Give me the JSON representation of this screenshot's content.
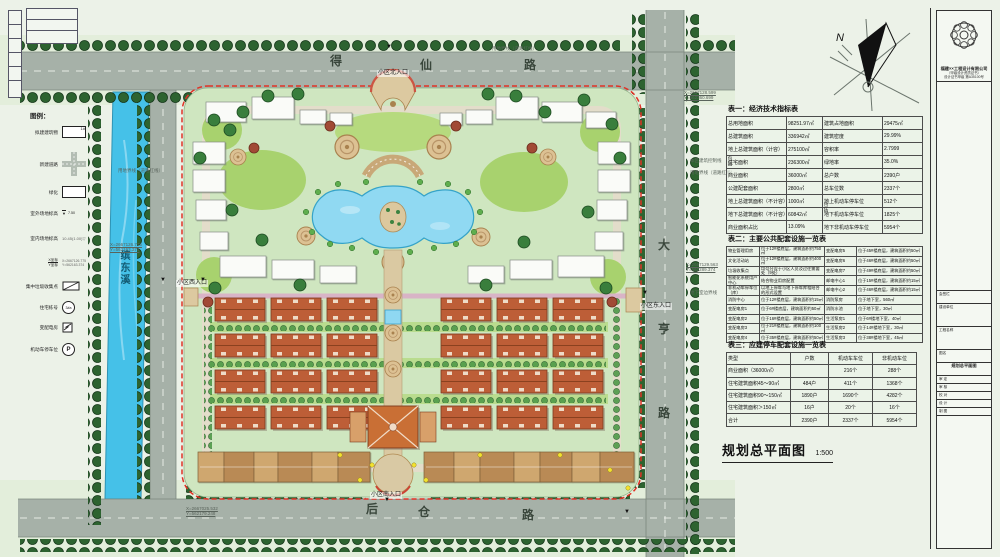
{
  "drawing": {
    "title": "规划总平面图",
    "scale": "1:500",
    "north_label": "N",
    "marker": "▼"
  },
  "roads": {
    "north": [
      "得",
      "仙",
      "路"
    ],
    "east": [
      "大",
      "亨",
      "路"
    ],
    "south": [
      "后",
      "仓",
      "路"
    ],
    "stream": "缤东溪"
  },
  "entrances": {
    "north": "小区北入口",
    "south": "小区南入口",
    "east": "小区东入口",
    "west": "小区西入口"
  },
  "annotations": {
    "red_line": "用地界线（道路红线）",
    "control_line": "本区建筑控制线",
    "basement_line": "地下室边界线",
    "coords": {
      "ne": [
        "X=2667128.599",
        "Y=562360.699"
      ],
      "e": [
        "X=2667129.563",
        "Y=562289.374"
      ],
      "w": [
        "X=2667126.775",
        "Y=562163.374"
      ],
      "sw": [
        "X=2667025.532",
        "Y=562179.248"
      ]
    }
  },
  "legend": {
    "title": "图例：",
    "items": [
      {
        "label": "拟建建筑物",
        "value": "1#"
      },
      {
        "label": "新建道路",
        "value": ""
      },
      {
        "label": "绿化",
        "value": ""
      },
      {
        "label": "室外场地标高",
        "value": "7.50"
      },
      {
        "label": "室内场地标高",
        "value": "10.45(1.00)"
      },
      {
        "label_x": "X坐标",
        "label_y": "Y坐标",
        "value_x": "X=2667126.775",
        "value_y": "Y=562163.374"
      },
      {
        "label": "集中垃圾收集点",
        "value": ""
      },
      {
        "label": "住宅栋号",
        "value": "3#a"
      },
      {
        "label": "变配电房",
        "value": ""
      },
      {
        "label": "机动车停车位",
        "value": "P"
      }
    ]
  },
  "tables": {
    "table1": {
      "title": "表一：经济技术指标表",
      "bracket": "包括",
      "rows": [
        [
          "总用地面积",
          "98251.97㎡",
          "建筑占地面积",
          "29475㎡"
        ],
        [
          "总建筑面积",
          "336942㎡",
          "建筑密度",
          "29.99%"
        ],
        [
          "地上总建筑面积（计容）",
          "275100㎡",
          "容积率",
          "2.7999"
        ],
        [
          "住宅面积",
          "236300㎡",
          "绿地率",
          "35.0%"
        ],
        [
          "商业面积",
          "36000㎡",
          "总户数",
          "2390户"
        ],
        [
          "公建配套面积",
          "2800㎡",
          "总车位数",
          "2337个"
        ],
        [
          "地上总建筑面积（不计容）",
          "1000㎡",
          "地上机动车停车位",
          "512个"
        ],
        [
          "地下总建筑面积（不计容）",
          "60842㎡",
          "地下机动车停车位",
          "1825个"
        ],
        [
          "商业面积占比",
          "13.09%",
          "地下非机动车停车位",
          "5954个"
        ]
      ]
    },
    "table2": {
      "title": "表二：主要公共配套设施一览表",
      "rows": [
        [
          "物业管理用房",
          "位于12#楼底层，建筑面积约750㎡",
          "变配电房5",
          "位于45#楼底层，建筑面积约50㎡"
        ],
        [
          "文化活动站",
          "位于12#楼底层，建筑面积约400㎡",
          "变配电房6",
          "位于46#楼底层，建筑面积约50㎡"
        ],
        [
          "垃圾收集点",
          "均匀分设于小区人员及过往需要处（9处）",
          "变配电房7",
          "位于49#楼底层，建筑面积约50㎡"
        ],
        [
          "智能化系统用户中心",
          "结合物业用房配置",
          "邮电中心1",
          "位于15#楼底层，建筑面积约15㎡"
        ],
        [
          "非机动车停车位（库）",
          "以地上停车与地下停车库相结合的形式设置",
          "邮电中心2",
          "位于46#楼底层，建筑面积约15㎡"
        ],
        [
          "消防中心",
          "位于12#楼底层，建筑面积约15㎡",
          "消防泵房",
          "位于地下室，560㎡"
        ],
        [
          "变配电房1",
          "位于6#楼底层，建筑面积约50㎡",
          "消防水池",
          "位于地下室，30㎡"
        ],
        [
          "变配电房2",
          "位于16#楼底层，建筑面积约50㎡",
          "生活泵房1",
          "位于6#楼地下室，40㎡"
        ],
        [
          "变配电房3",
          "位于21#楼底层，建筑面积约100㎡",
          "生活泵房2",
          "位于14#楼地下室，30㎡"
        ],
        [
          "变配电房4",
          "位于35#楼底层，建筑面积约50㎡",
          "生活泵房3",
          "位于38#楼地下室，45㎡"
        ]
      ]
    },
    "table3": {
      "title": "表三：应建停车配套设施一览表",
      "rows": [
        [
          "类型",
          "户数",
          "机动车车位",
          "非机动车位"
        ],
        [
          "商业面积（36000㎡）",
          "",
          "216个",
          "288个"
        ],
        [
          "住宅建筑面积45～90㎡",
          "484户",
          "411个",
          "1368个"
        ],
        [
          "住宅建筑面积90～150㎡",
          "1890户",
          "1690个",
          "4282个"
        ],
        [
          "住宅建筑面积＞150㎡",
          "16户",
          "20个",
          "16个"
        ],
        [
          "合计",
          "2390户",
          "2337个",
          "5954个"
        ]
      ]
    }
  },
  "titleblock": {
    "company": "福建××工程设计有限公司",
    "company_sub": "（甲级设计资质证书）",
    "cert": "设计证书甲级 第A35100号",
    "rows": [
      "会签栏",
      "建设单位",
      "工程名称",
      "图名"
    ],
    "drawing_name": "规划总平面图",
    "small_rows": [
      "审 定",
      "审 核",
      "校 对",
      "设 计",
      "制 图"
    ]
  },
  "colors": {
    "water": "#45c1e8",
    "pond": "#90d9f2",
    "boundary_red": "#e03226",
    "roof_orange": "#bd5e37",
    "lawn": "#a8d26e",
    "road_gray": "#a6b1a8"
  }
}
